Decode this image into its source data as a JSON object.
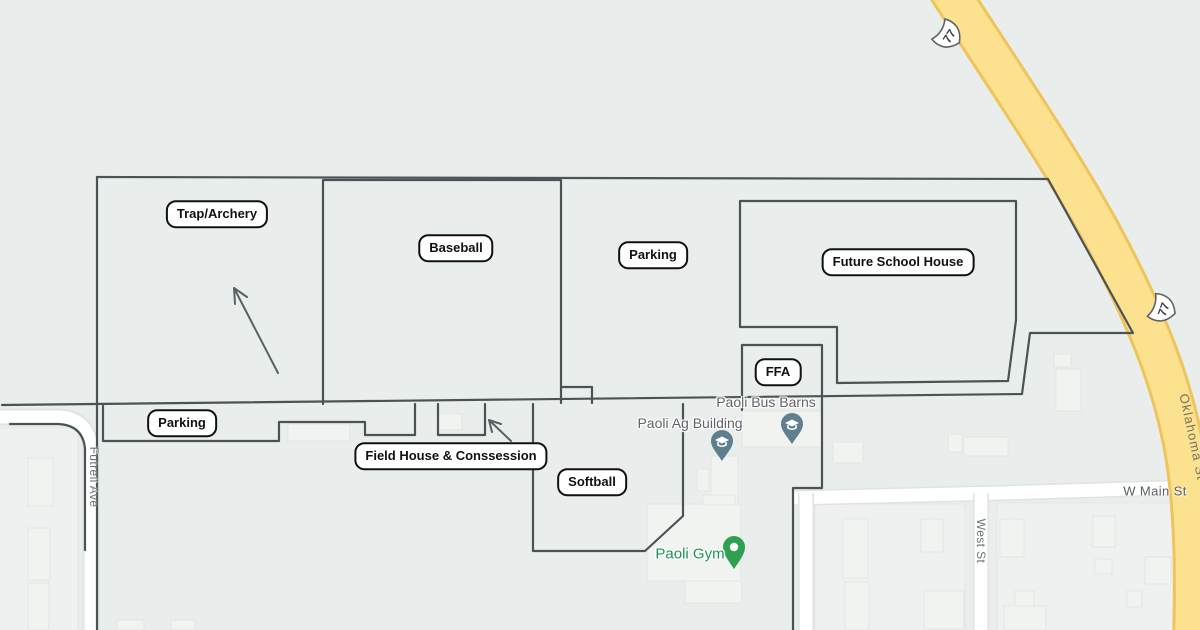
{
  "title": "Paoli school facilities map",
  "colors": {
    "background": "#e9edeb",
    "highway_fill": "#fce18e",
    "highway_casing": "#efc45c",
    "road_fill": "#ffffff",
    "annotation_line": "#4c5357",
    "label_box_border": "#111111",
    "street_label_gray": "#6d7276",
    "poi_label_gray": "#5f6469",
    "gym_label_green": "#1a9551",
    "school_pin": "#5f7f8f",
    "gym_pin": "#2fa052"
  },
  "annotations": {
    "trap_archery": "Trap/Archery",
    "baseball": "Baseball",
    "parking_top": "Parking",
    "future_school_house": "Future School House",
    "ffa": "FFA",
    "parking_bottom": "Parking",
    "field_house": "Field House & Conssession",
    "softball": "Softball"
  },
  "map_labels": {
    "paoli_bus_barns": "Paoli Bus Barns",
    "paoli_ag_building": "Paoli Ag Building",
    "paoli_gym": "Paoli Gym",
    "futrell_ave": "Futrell Ave",
    "west_st": "West St",
    "w_main_st": "W Main St",
    "oklahoma_st": "Oklahoma St",
    "route_77_shield_top": "77",
    "route_77_shield_bottom": "77"
  },
  "icons": {
    "school_pin": "graduation-cap-pin-icon",
    "gym_pin": "place-pin-icon",
    "route_shield": "us-route-shield-icon",
    "arrows": "hand-drawn-arrow"
  }
}
